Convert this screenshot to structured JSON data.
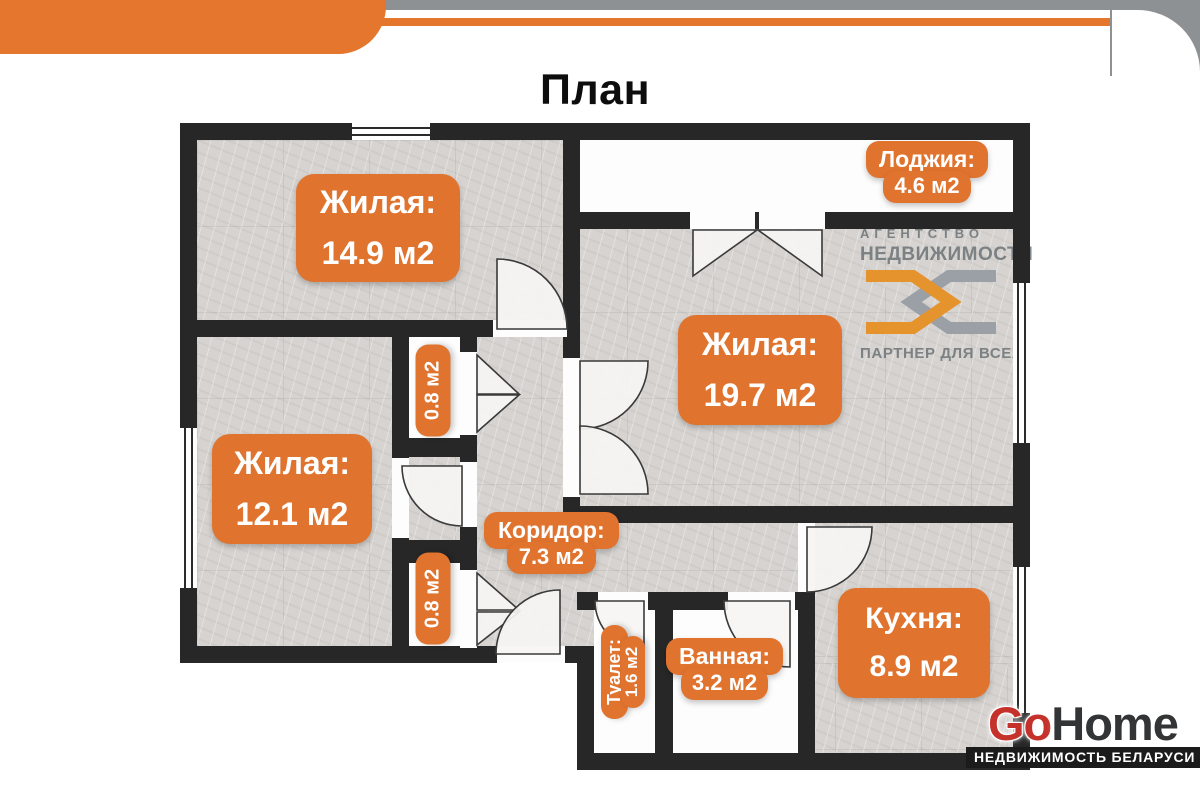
{
  "title": "План",
  "plan": {
    "rooms": [
      {
        "key": "living1",
        "name": "Жилая:",
        "area": "14.9 м2"
      },
      {
        "key": "loggia",
        "name": "Лоджия:",
        "area": "4.6 м2"
      },
      {
        "key": "living2",
        "name": "Жилая:",
        "area": "19.7 м2"
      },
      {
        "key": "living3",
        "name": "Жилая:",
        "area": "12.1 м2"
      },
      {
        "key": "closet1",
        "area": "0.8 м2"
      },
      {
        "key": "closet2",
        "area": "0.8 м2"
      },
      {
        "key": "corridor",
        "name": "Коридор:",
        "area": "7.3 м2"
      },
      {
        "key": "toilet",
        "name": "Туалет:",
        "area": "1.6 м2"
      },
      {
        "key": "bathroom",
        "name": "Ванная:",
        "area": "3.2 м2"
      },
      {
        "key": "kitchen",
        "name": "Кухня:",
        "area": "8.9 м2"
      }
    ]
  },
  "watermark": {
    "line1": "АГЕНТСТВО",
    "line2": "НЕДВИЖИМОСТИ",
    "tagline": "ПАРТНЕР ДЛЯ ВСЕХ"
  },
  "brand": {
    "name_part1": "Go",
    "name_part2": "Home",
    "tagline": "НЕДВИЖИМОСТЬ БЕЛАРУСИ"
  },
  "colors": {
    "accent_orange": "#e0732e",
    "header_orange": "#e5762e",
    "wall_dark": "#272727",
    "top_gray": "#8e9193",
    "brand_red": "#c5322c",
    "brand_dark": "#323435"
  }
}
